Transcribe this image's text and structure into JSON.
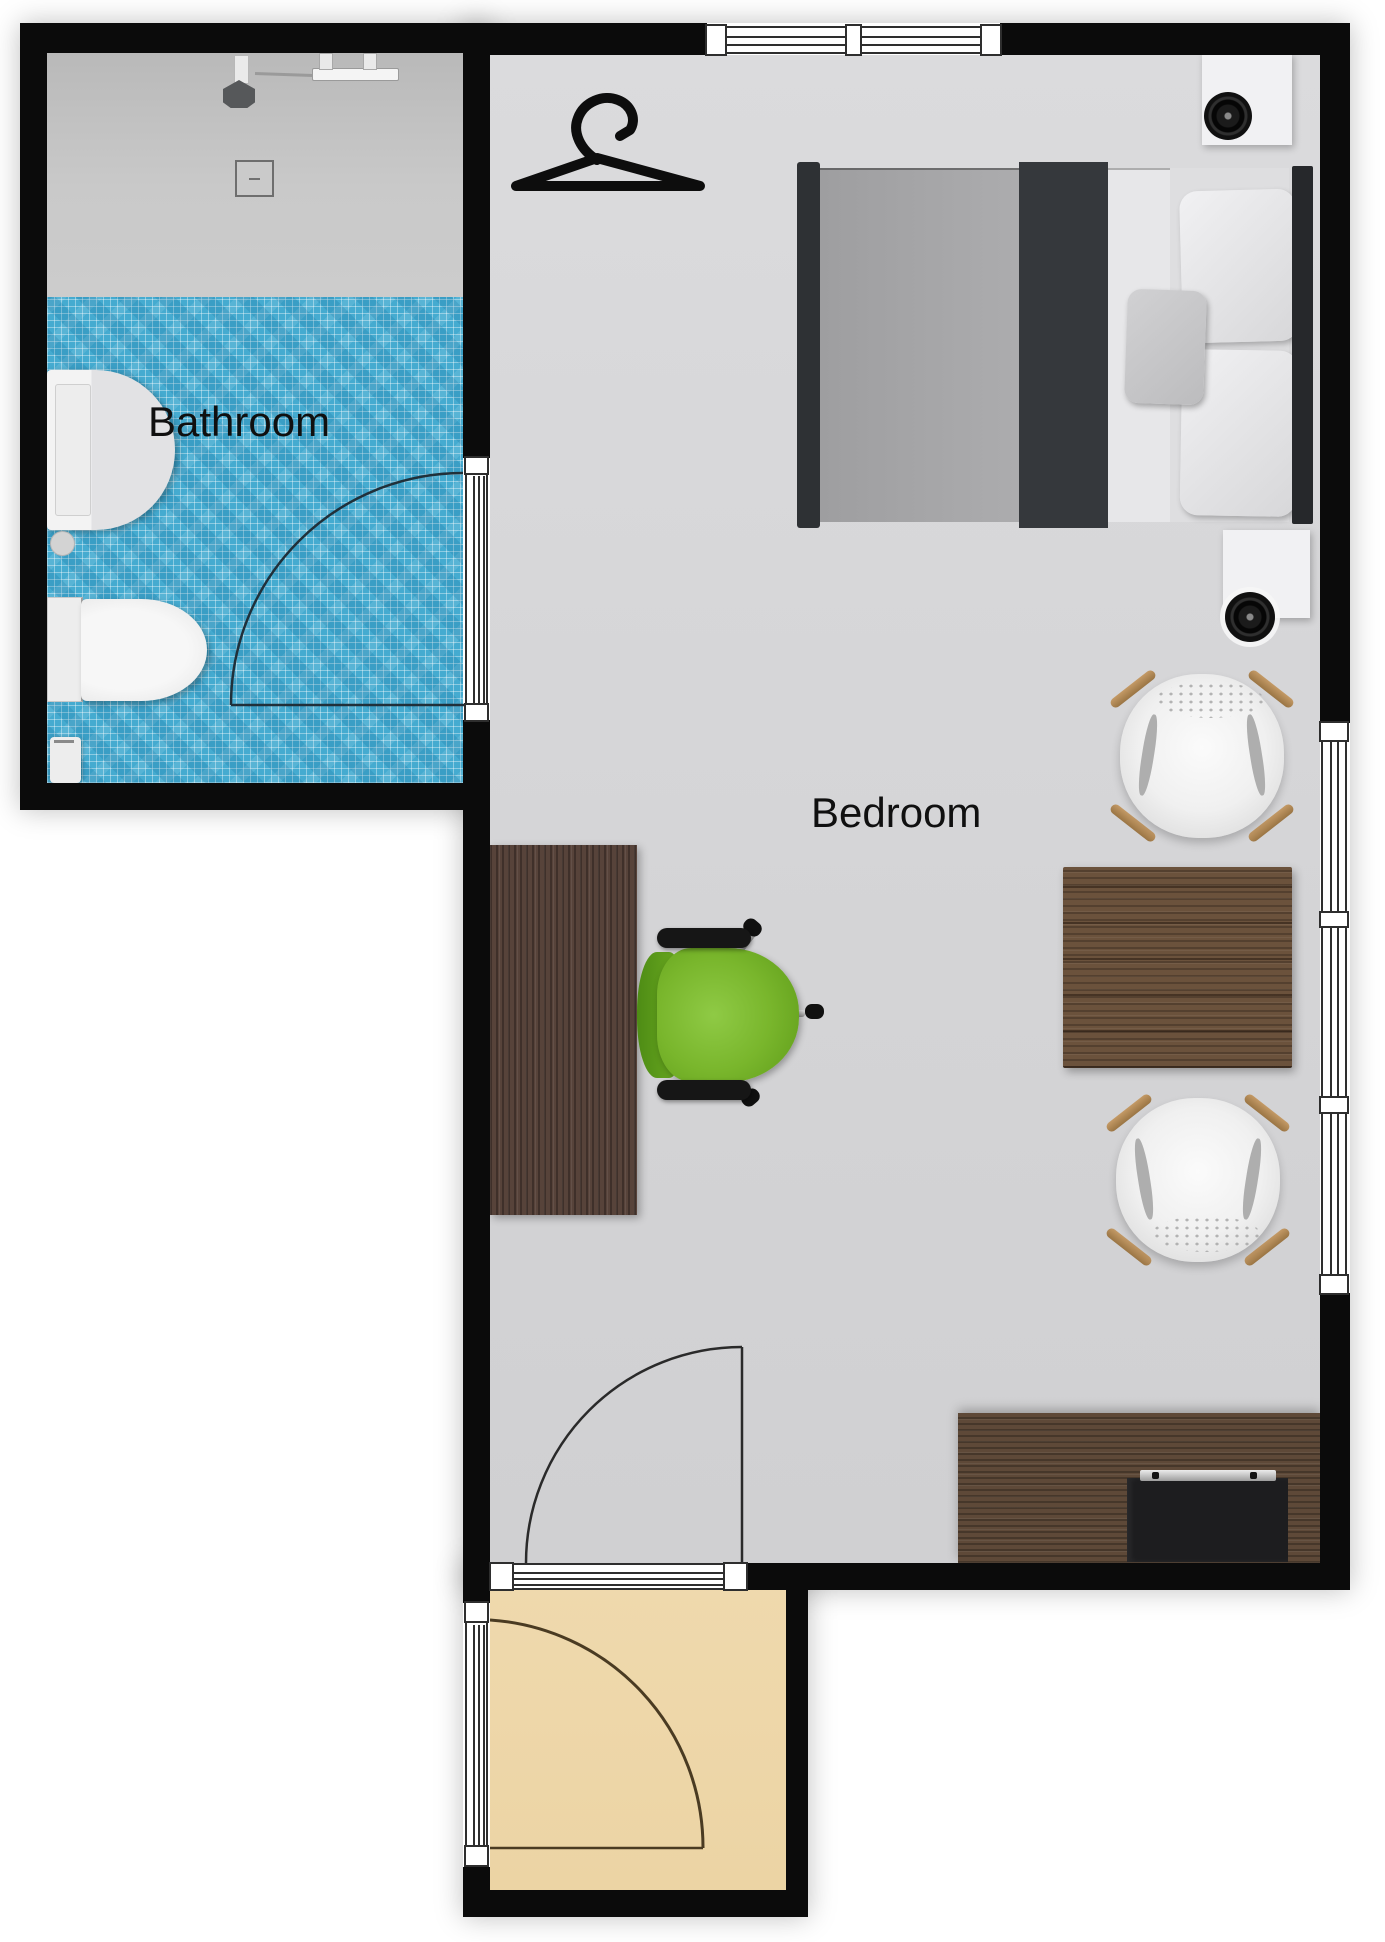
{
  "page": {
    "title": "Apartment floor plan",
    "background": "#ffffff"
  },
  "rooms": {
    "bathroom": {
      "label": "Bathroom"
    },
    "bedroom": {
      "label": "Bedroom"
    }
  },
  "objects": {
    "bathroom": [
      "shower-area",
      "shower-head",
      "shower-rail",
      "floor-drain",
      "sink",
      "toilet",
      "waste-bin",
      "door-swing"
    ],
    "bedroom": [
      "clothes-hanger-icon",
      "double-bed",
      "pillows",
      "nightstand",
      "speaker",
      "lounge-chair",
      "side-table",
      "lounge-chair",
      "desk",
      "office-chair",
      "tv-console",
      "tv",
      "door-swing",
      "window"
    ],
    "entry": [
      "door-swing",
      "window"
    ]
  },
  "colors": {
    "wall": "#0b0b0b",
    "bedroom_floor": "#d6d6d8",
    "shower_floor": "#c3c3c3",
    "bathroom_tile": "#45abd0",
    "entry_floor": "#eed7a9",
    "desk_wood": "#57433a",
    "table_wood": "#6b523c",
    "console_wood": "#5e4938",
    "office_chair_green": "#79b62c",
    "chair_leg_wood": "#b3885a",
    "bed_blanket": "#35383c",
    "bed_mattress": "#a5a5a7"
  }
}
